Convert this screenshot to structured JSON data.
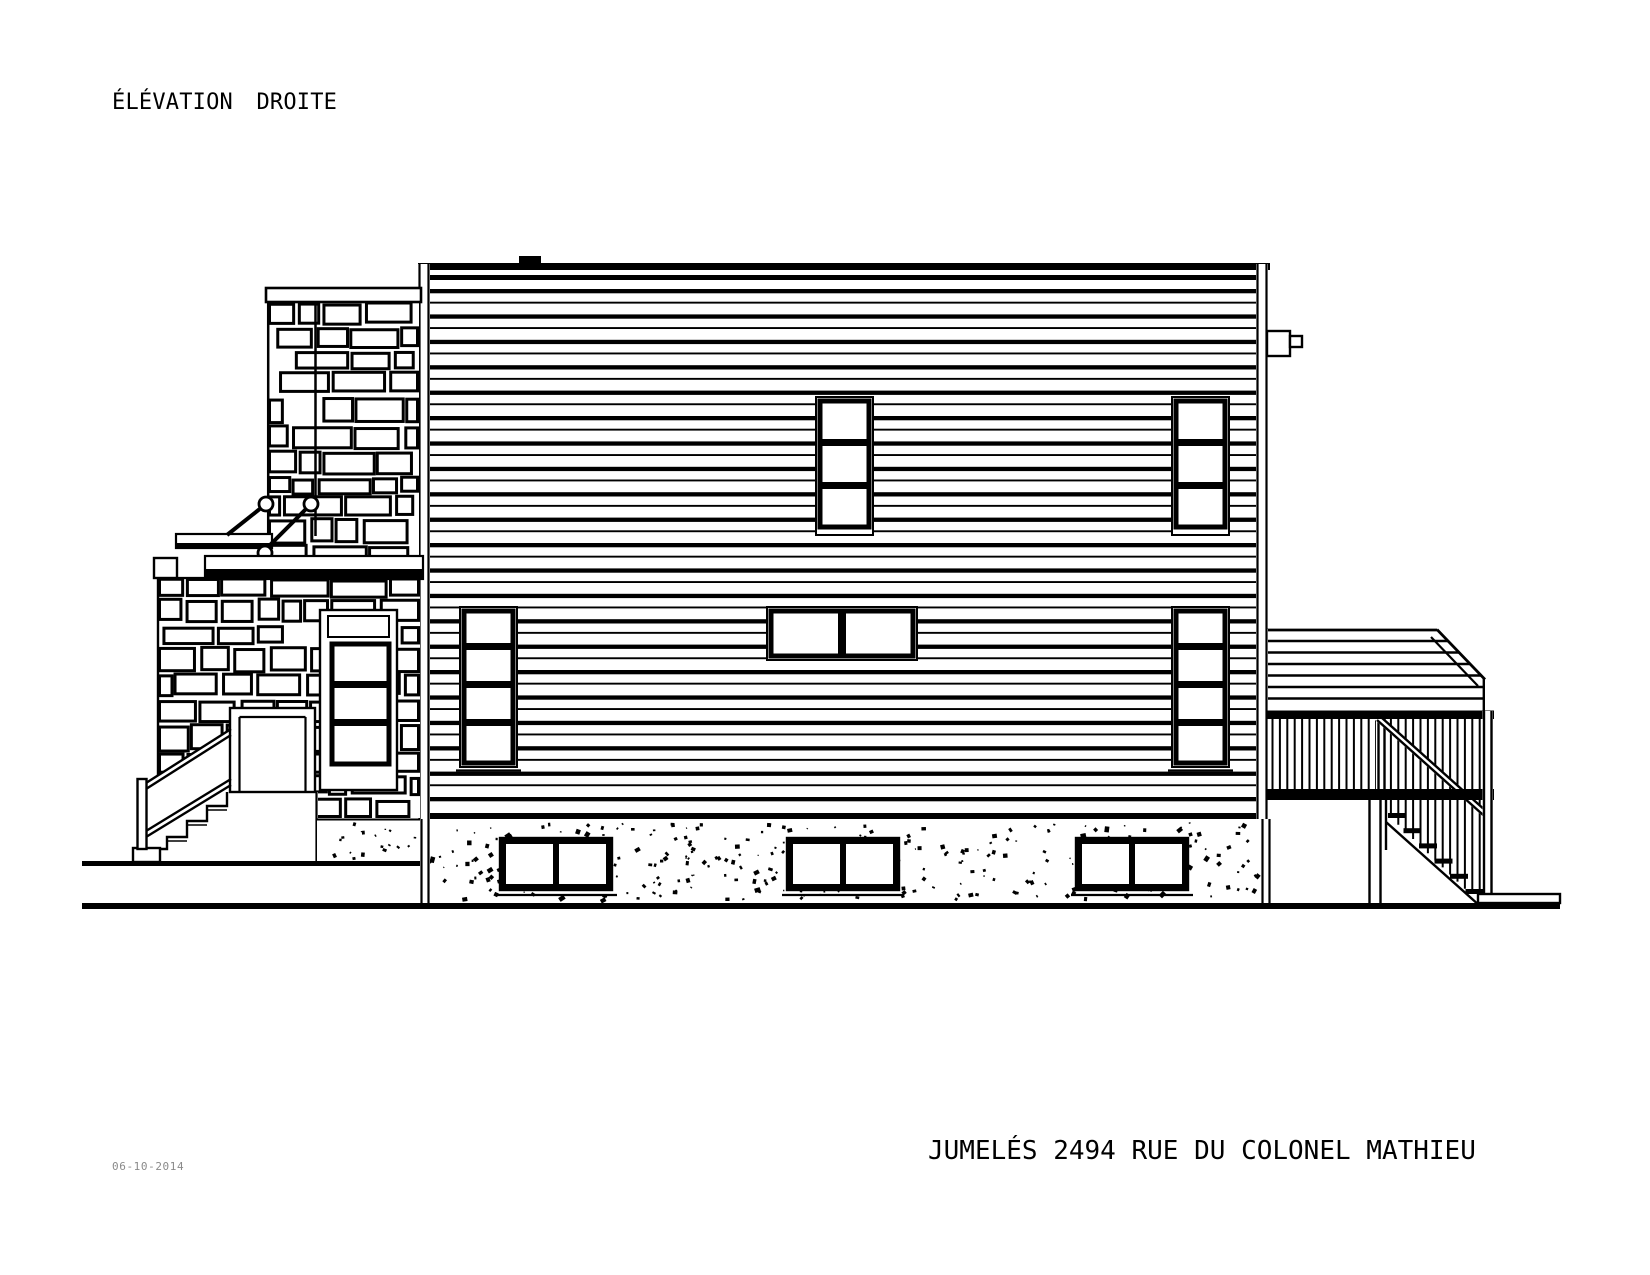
{
  "page": {
    "background": "#ffffff",
    "ink": "#000000",
    "muted_ink": "#8a8a8a"
  },
  "titles": {
    "drawing_label": "ÉLÉVATION DROITE",
    "project_label": "JUMELÉS 2494 RUE DU COLONEL MATHIEU",
    "date_label": "06-10-2014"
  }
}
